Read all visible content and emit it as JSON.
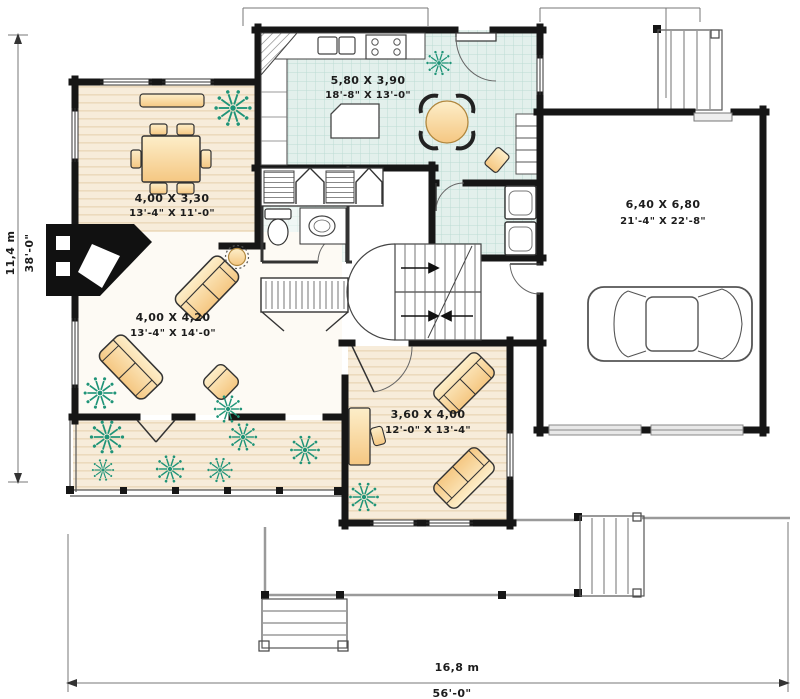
{
  "rooms": {
    "kitchen": {
      "metric": "5,80 X 3,90",
      "imperial": "18'-8\" X 13'-0\""
    },
    "dining": {
      "metric": "4,00 X 3,30",
      "imperial": "13'-4\" X 11'-0\""
    },
    "living": {
      "metric": "4,00 X 4,20",
      "imperial": "13'-4\" X 14'-0\""
    },
    "den": {
      "metric": "3,60 X 4,00",
      "imperial": "12'-0\" X 13'-4\""
    },
    "garage": {
      "metric": "6,40 X 6,80",
      "imperial": "21'-4\" X 22'-8\""
    }
  },
  "dimensions": {
    "left": {
      "metric": "11,4 m",
      "imperial": "38'-0\""
    },
    "bottom": {
      "metric": "16,8 m",
      "imperial": "56'-0\""
    }
  },
  "colors": {
    "wall": "#161616",
    "tile": "#e3f0ec",
    "tile_grid": "#bcdcd4",
    "wood": "#f7ecda",
    "wood_stripe": "#ecdabd",
    "furniture": "#fbe3ad",
    "plant": "#1f9478",
    "porch": "#9a9a9a",
    "text": "#1c1c1c"
  }
}
